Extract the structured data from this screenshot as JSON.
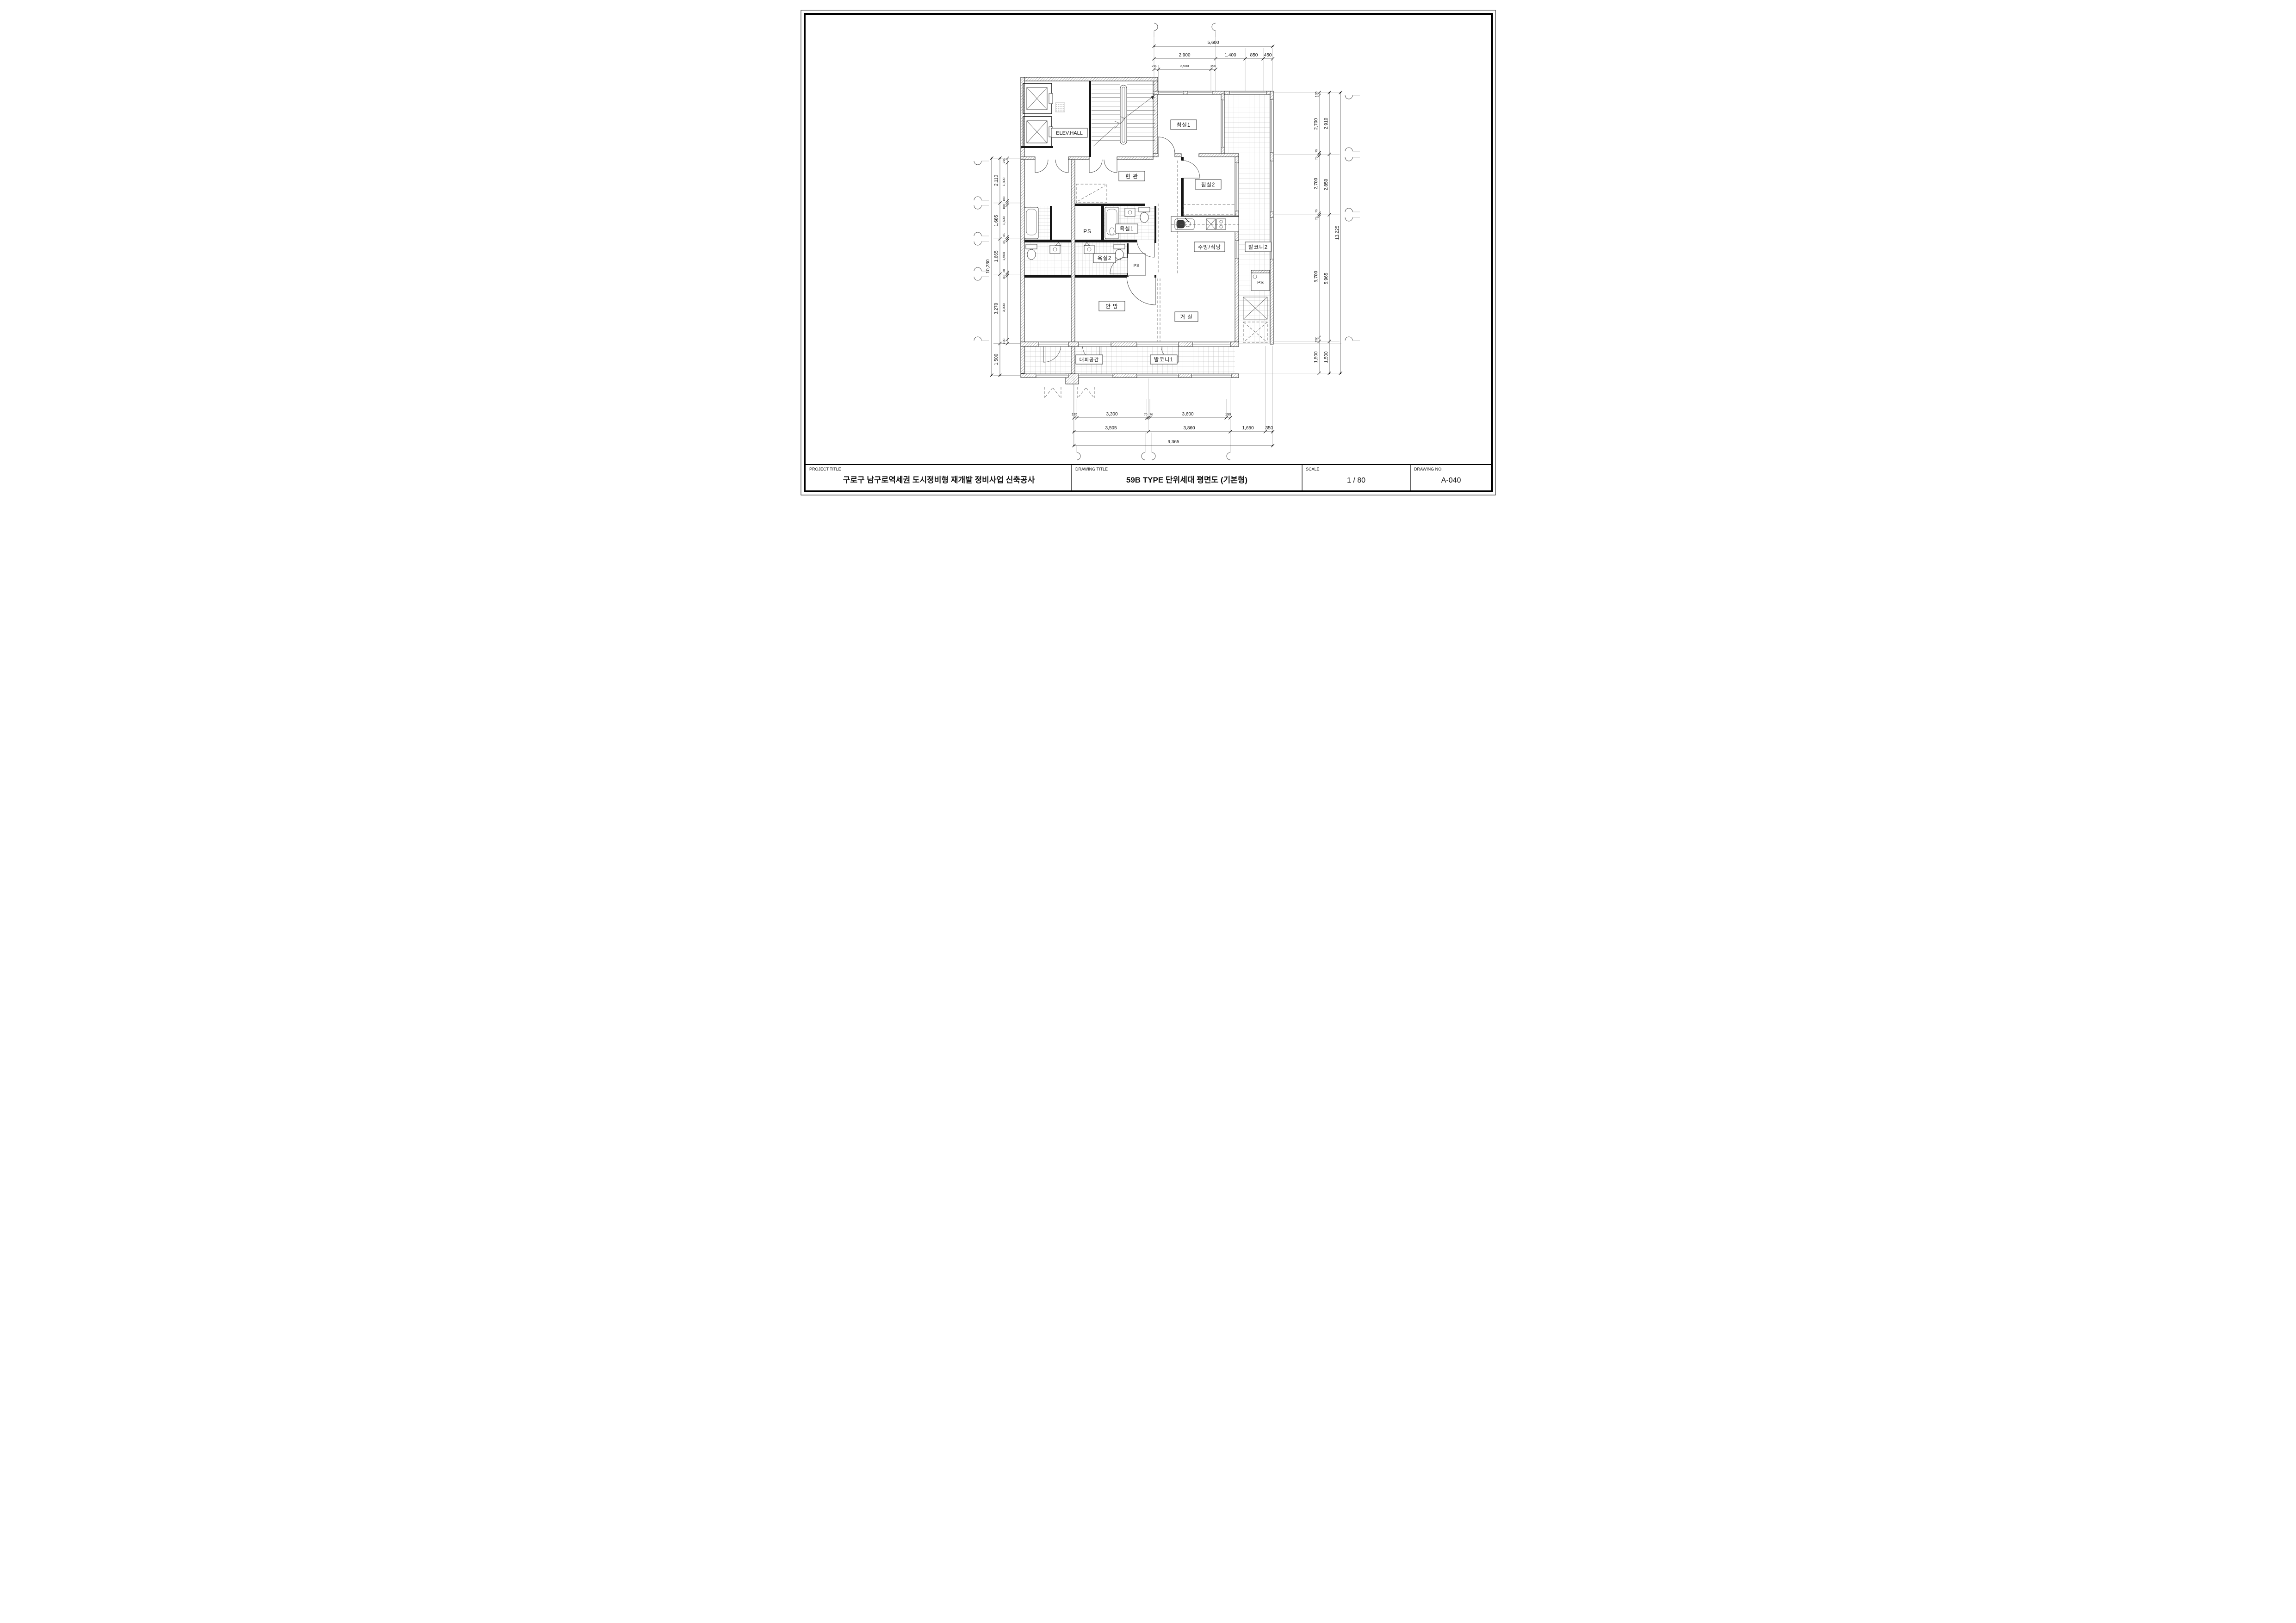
{
  "titleblock": {
    "project_title_label": "PROJECT TITLE",
    "project_title": "구로구 남구로역세권 도시정비형 재개발 정비사업 신축공사",
    "drawing_title_label": "DRAWING TITLE",
    "drawing_title": "59B TYPE 단위세대 평면도 (기본형)",
    "scale_label": "SCALE",
    "scale_value": "1 / 80",
    "drawing_no_label": "DRAWING NO.",
    "drawing_no": "A-040"
  },
  "rooms": {
    "bedroom1": "침실1",
    "bedroom2": "침실2",
    "entrance": "현 관",
    "bath1": "욕실1",
    "bath2": "욕실2",
    "master_bedroom": "안 방",
    "living": "거 실",
    "kitchen": "주방/식당",
    "balcony1": "발코니1",
    "balcony2": "발코니2",
    "refuge": "대피공간",
    "elev_hall": "ELEV.HALL",
    "ps": "PS"
  },
  "dims": {
    "top": {
      "total": "5,600",
      "row": [
        "2,900",
        "1,400",
        "850",
        "450"
      ],
      "sub": [
        "210",
        "2,500",
        "190"
      ]
    },
    "bottom": {
      "total": "9,365",
      "row": [
        "3,505",
        "3,860",
        "1,650",
        "350"
      ],
      "sub": [
        "135",
        "3,300",
        "70",
        "70",
        "3,600",
        "190"
      ]
    },
    "left": {
      "total": "10,230",
      "row": [
        "2,110",
        "1,685",
        "1,665",
        "3,270",
        "1,500"
      ],
      "sub": [
        "210",
        "1,800",
        "100",
        "100",
        "1,500",
        "85",
        "85",
        "1,500",
        "80",
        "80",
        "3,000",
        "190"
      ]
    },
    "right": {
      "total": "13,225",
      "row": [
        "2,910",
        "2,850",
        "5,965",
        "1,500"
      ],
      "sub": [
        "135",
        "2,700",
        "75",
        "75",
        "2,700",
        "75",
        "75",
        "5,700",
        "190",
        "1,500"
      ]
    }
  }
}
